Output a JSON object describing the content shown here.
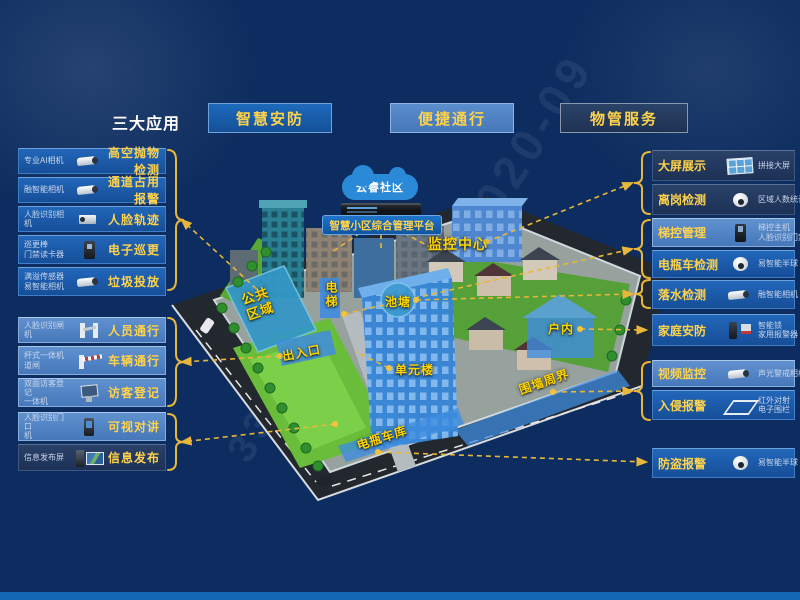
{
  "palette": {
    "background": "#0d2d60",
    "box_blue": "#1a5cae",
    "box_light_blue": "#4d82c4",
    "box_dark_navy": "#21395f",
    "accent_yellow": "#ffd24a",
    "map_label_yellow": "#ffd400",
    "line_yellow": "#e8b73a",
    "footer_blue": "#1467b4"
  },
  "header": {
    "title": "三大应用",
    "apps": [
      {
        "label": "智慧安防"
      },
      {
        "label": "便捷通行"
      },
      {
        "label": "物管服务"
      }
    ]
  },
  "left_items": [
    {
      "device": "专业AI相机",
      "label": "高空抛物检测",
      "icon": "bullet-camera"
    },
    {
      "device": "融智能相机",
      "label": "通道占用报警",
      "icon": "bullet-camera"
    },
    {
      "device": "人脸识别相机",
      "label": "人脸轨迹",
      "icon": "box-camera"
    },
    {
      "device": "巡更棒\n门禁读卡器",
      "label": "电子巡更",
      "icon": "card-reader"
    },
    {
      "device": "满溢传感器\n易智能相机",
      "label": "垃圾投放",
      "icon": "bullet-camera"
    },
    {
      "device": "人脸识别闸机",
      "label": "人员通行",
      "icon": "turnstile"
    },
    {
      "device": "杆式一体机\n道闸",
      "label": "车辆通行",
      "icon": "barrier-gate"
    },
    {
      "device": "双面访客登记\n一体机",
      "label": "访客登记",
      "icon": "registration-kiosk"
    },
    {
      "device": "人脸识别门口\n机",
      "label": "可视对讲",
      "icon": "door-intercom"
    },
    {
      "device": "信息发布屏",
      "label": "信息发布",
      "icon": "info-screen"
    }
  ],
  "right_items": [
    {
      "label": "大屏展示",
      "device": "拼接大屏",
      "icon": "video-wall"
    },
    {
      "label": "离岗检测",
      "device": "区域人数统计",
      "icon": "dome-camera"
    },
    {
      "label": "梯控管理",
      "device": "梯控主机\n人脸识别门禁",
      "icon": "elevator-panel"
    },
    {
      "label": "电瓶车检测",
      "device": "易智能半球",
      "icon": "dome-camera"
    },
    {
      "label": "落水检测",
      "device": "融智能相机",
      "icon": "bullet-camera"
    },
    {
      "label": "家庭安防",
      "device": "智能锁\n家用报警器",
      "icon": "lock-siren"
    },
    {
      "label": "视频监控",
      "device": "声光警戒相机",
      "icon": "bullet-camera"
    },
    {
      "label": "入侵报警",
      "device": "红外对射\n电子围栏",
      "icon": "infrared-fence"
    },
    {
      "label": "防盗报警",
      "device": "易智能半球",
      "icon": "dome-camera"
    }
  ],
  "map": {
    "cloud_label": "云睿社区",
    "platform_label": "智慧小区综合管理平台",
    "monitor_center": "监控中心",
    "elevator": "电梯",
    "pond": "池塘",
    "public_area_line1": "公共",
    "public_area_line2": "区域",
    "entrance": "出入口",
    "unit_building": "单元楼",
    "indoor": "户内",
    "perimeter": "围墙周界",
    "ebike_garage": "电瓶车库"
  },
  "watermark": {
    "w1": "2020-09",
    "w2": "339"
  }
}
